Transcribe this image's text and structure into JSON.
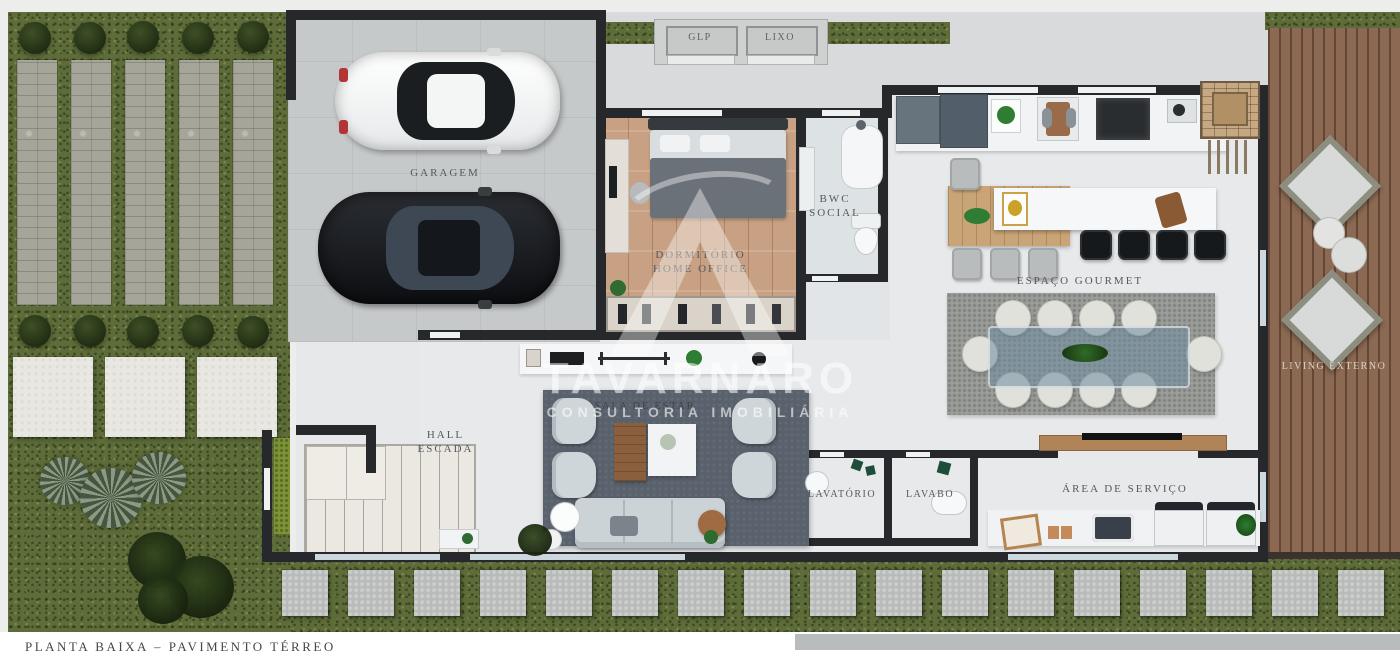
{
  "caption": "PLANTA BAIXA – PAVIMENTO TÉRREO",
  "watermark": {
    "name": "TAVARNARO",
    "tagline": "CONSULTORIA IMOBILIÁRIA"
  },
  "rooms": {
    "garagem": {
      "label": "GARAGEM"
    },
    "glp": {
      "label": "GLP"
    },
    "lixo": {
      "label": "LIXO"
    },
    "dormitorio": {
      "line1": "DORMITÓRIO",
      "line2": "HOME OFFICE"
    },
    "bwc": {
      "line1": "BWC",
      "line2": "SOCIAL"
    },
    "espaco_gourmet": {
      "label": "ESPAÇO GOURMET"
    },
    "sala_estar": {
      "label": "SALA DE ESTAR"
    },
    "hall": {
      "line1": "HALL",
      "line2": "ESCADA"
    },
    "lavatorio": {
      "label": "LAVATÓRIO"
    },
    "lavabo": {
      "label": "LAVABO"
    },
    "area_servico": {
      "label": "ÁREA DE SERVIÇO"
    },
    "living_externo": {
      "label": "LIVING EXTERNO"
    }
  },
  "colors": {
    "grass": "#5d6c39",
    "deck_wood": "#8b6952",
    "wall": "#26282b",
    "living_rug": "#59616c",
    "dining_rug": "#9a9d99",
    "bedroom_wood": "#c8a184"
  }
}
